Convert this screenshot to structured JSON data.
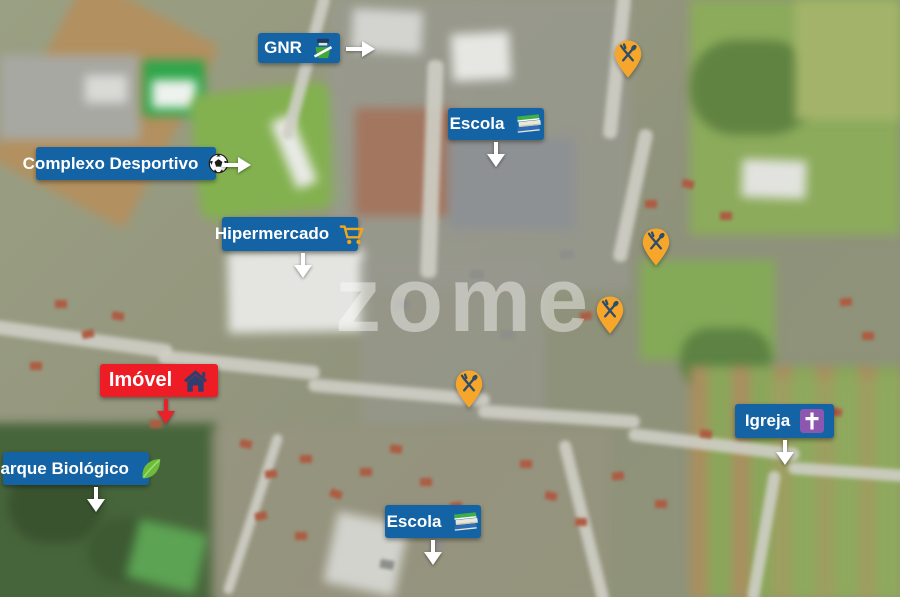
{
  "watermark": "zome",
  "colors": {
    "label_background": "#1463a5",
    "property_label_background": "#ee1c24",
    "label_text": "#ffffff",
    "pin_fill": "#f5a62b",
    "pin_glyph": "#2d4d6b",
    "arrow_white": "#ffffff",
    "arrow_red": "#e8212a"
  },
  "markers": [
    {
      "id": "gnr",
      "label": "GNR",
      "icon": "gnr-police-icon",
      "arrow": "right"
    },
    {
      "id": "escola-top",
      "label": "Escola",
      "icon": "books-icon",
      "arrow": "down"
    },
    {
      "id": "complexo-desportivo",
      "label": "Complexo Desportivo",
      "icon": "soccer-ball-icon",
      "arrow": "right"
    },
    {
      "id": "hipermercado",
      "label": "Hipermercado",
      "icon": "shopping-cart-icon",
      "arrow": "down"
    },
    {
      "id": "imovel",
      "label": "Imóvel",
      "icon": "house-icon",
      "arrow": "down",
      "highlight": true
    },
    {
      "id": "parque-biologico",
      "label": "Parque Biológico",
      "icon": "leaf-icon",
      "arrow": "down"
    },
    {
      "id": "igreja",
      "label": "Igreja",
      "icon": "church-cross-icon",
      "arrow": "down"
    },
    {
      "id": "escola-bottom",
      "label": "Escola",
      "icon": "books-icon",
      "arrow": "down"
    }
  ],
  "pins": [
    {
      "id": "restaurant-1",
      "icon": "restaurant-pin-icon"
    },
    {
      "id": "restaurant-2",
      "icon": "restaurant-pin-icon"
    },
    {
      "id": "restaurant-3",
      "icon": "restaurant-pin-icon"
    },
    {
      "id": "restaurant-4",
      "icon": "restaurant-pin-icon"
    }
  ]
}
